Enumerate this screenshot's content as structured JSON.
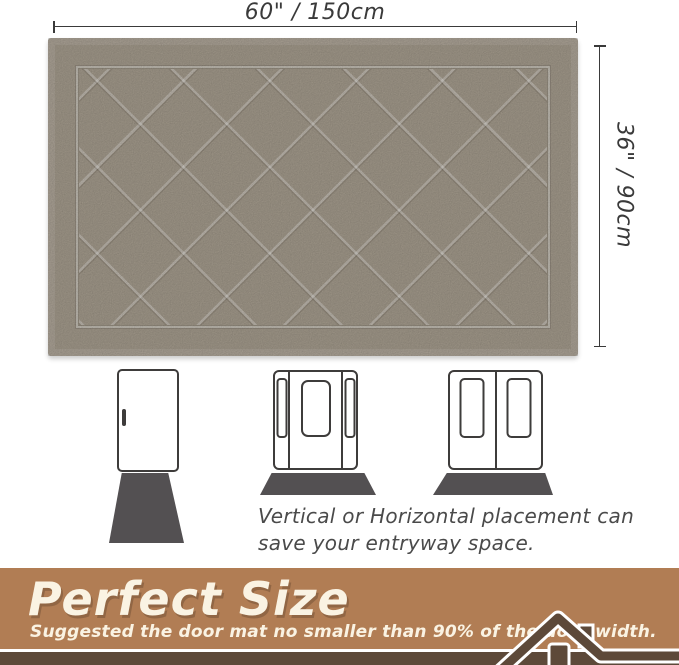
{
  "dimensions": {
    "width_label": "60\" / 150cm",
    "height_label": "36\" / 90cm"
  },
  "placement_note": {
    "line1": "Vertical or Horizontal placement can",
    "line2": "save your entryway space."
  },
  "banner": {
    "title": "Perfect Size",
    "subtitle": "Suggested the door mat no smaller than 90% of the door width."
  },
  "icons": {
    "house_roof": "house-roof-icon",
    "single_door": "single-door-icon",
    "sidelight_door": "door-with-sidelights-icon",
    "double_door": "double-door-icon"
  },
  "colors": {
    "mat": "#a79e8f",
    "door_mat_gray": "#535052",
    "door_outline": "#3e3c3b",
    "banner_bg": "#b17d54",
    "banner_dark": "#5d4939",
    "banner_text": "#faf3e3",
    "dimension_ink": "#3a3a3a",
    "note_ink": "#4a4a4a"
  }
}
